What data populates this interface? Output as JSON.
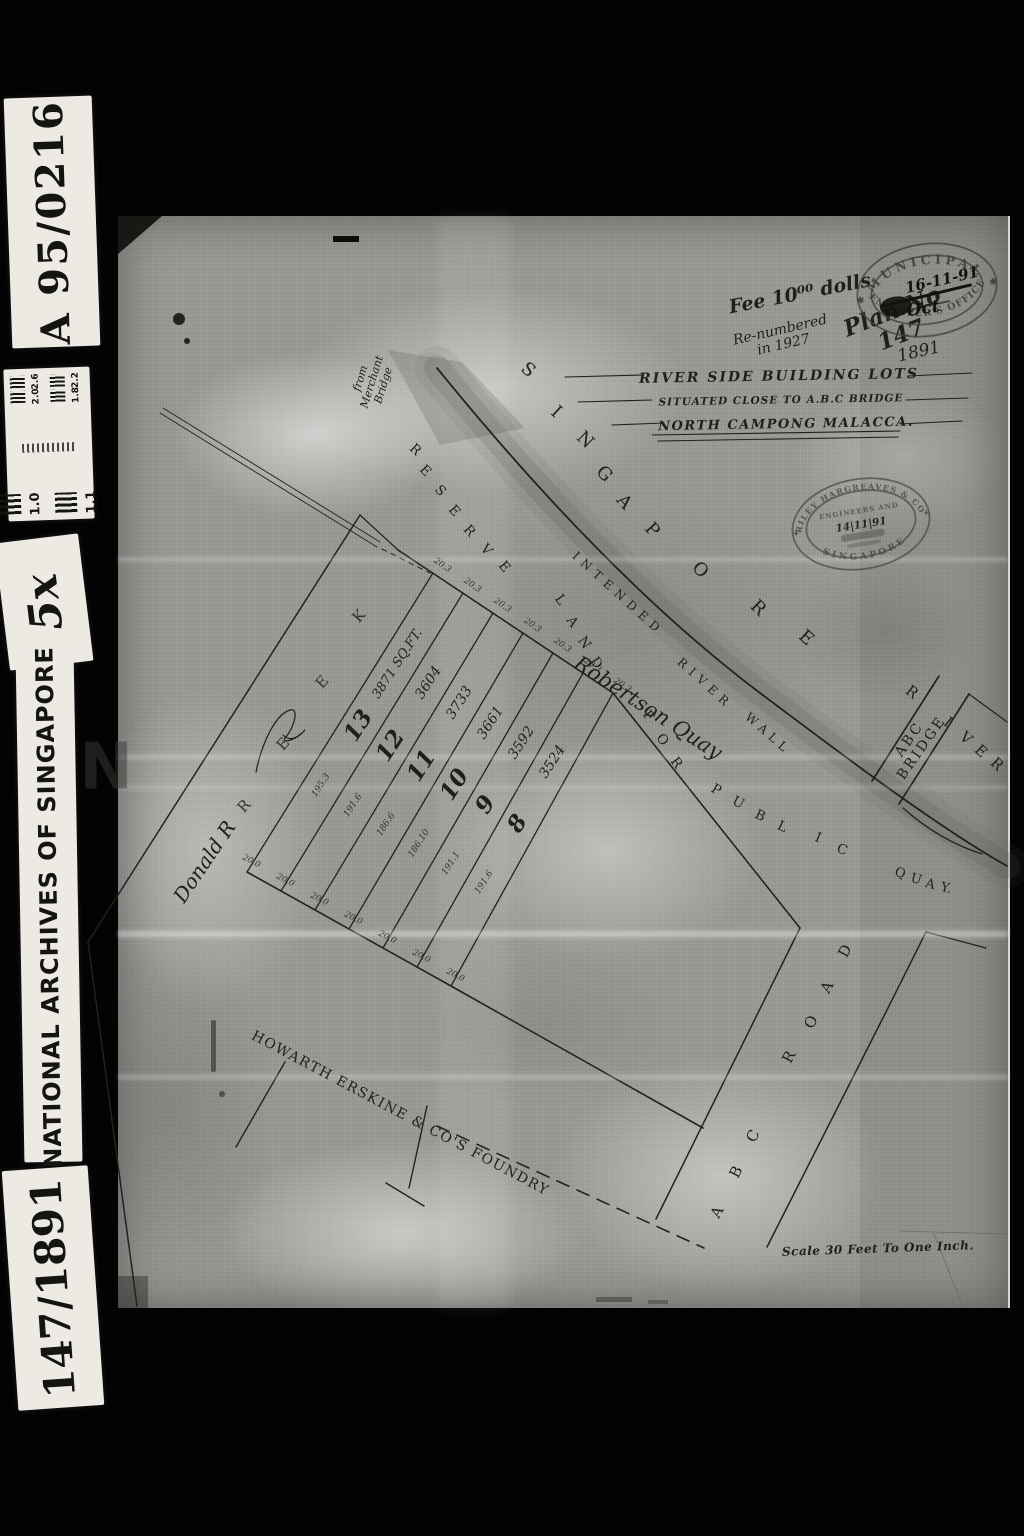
{
  "frame": {
    "catalog_ref": "A 95/0216",
    "magnification": "5x",
    "institution": "NATIONAL ARCHIVES OF SINGAPORE",
    "item_ref": "147/1891",
    "calibration": {
      "left": [
        "1.0",
        "1.1"
      ],
      "right": [
        "2.6",
        "2.2",
        "2.0",
        "1.8"
      ]
    }
  },
  "title_block": {
    "line1": "RIVER SIDE BUILDING LOTS",
    "line2": "SITUATED CLOSE TO A.B.C BRIDGE",
    "line3": "NORTH CAMPONG MALACCA."
  },
  "plan": {
    "lots": [
      {
        "number": "13",
        "area": "3871 SQ.FT.",
        "side": "195.3"
      },
      {
        "number": "12",
        "area": "3604",
        "side": "191.6"
      },
      {
        "number": "11",
        "area": "3733",
        "side": "186.6"
      },
      {
        "number": "10",
        "area": "3661",
        "side": "186.10"
      },
      {
        "number": "9",
        "area": "3592",
        "side": "191.1"
      },
      {
        "number": "8",
        "area": "3524",
        "side": "191.6"
      }
    ],
    "top_dimension": "20.3",
    "bottom_dimension": "20.0",
    "labels": {
      "river_upper": "SINGAPORE",
      "river_lower": "RIVER",
      "reserve_strip": "RESERVE LAND FOR PUBLIC QUAY",
      "wall": "INTENDED RIVER WALL",
      "bridge": "ABC BRIDGE",
      "road": "ABC ROAD",
      "foundry": "HOWARTH ERSKINE & CO'S FOUNDRY",
      "scale": "Scale 30 Feet To One Inch."
    }
  },
  "annotations": {
    "fee": "Fee 10⁰⁰ dolls",
    "renumbered": "Re-numbered\nin 1927",
    "plan_no": "Plan No 147",
    "year": "1891",
    "merchant_bridge": "from\nMerchant\nBridge",
    "robertson": "Robertson Quay",
    "owner_sig": "Donald R",
    "watermark": "N"
  },
  "stamps": {
    "municipal": {
      "ring_top": "MUNICIPAL",
      "ring_bottom": "ENGINEER'S OFFICE",
      "date": "16-11-91",
      "month": "Oct",
      "star": "✱"
    },
    "hargreaves": {
      "ring_top": "RILEY HARGREAVES & CO",
      "ring_bottom": "SINGAPORE",
      "inner": "ENGINEERS AND",
      "date": "14|11|91",
      "star": "✦"
    }
  },
  "scatter": [
    {
      "b": "title_block.line1",
      "x": 779,
      "y": 377,
      "r": -1,
      "s": 14,
      "ls": 2,
      "c": "ttl",
      "n": "title-line-1"
    },
    {
      "b": "title_block.line2",
      "x": 781,
      "y": 401,
      "r": -1,
      "s": 10.5,
      "ls": 1,
      "c": "ttl",
      "n": "title-line-2"
    },
    {
      "b": "title_block.line3",
      "x": 786,
      "y": 425,
      "r": -1,
      "s": 13,
      "ls": 1.5,
      "c": "ttl",
      "n": "title-line-3"
    },
    {
      "t": "S",
      "x": 528,
      "y": 370,
      "r": 40,
      "s": 18,
      "c": "ltr",
      "n": "singapore-letter"
    },
    {
      "t": "I",
      "x": 556,
      "y": 412,
      "r": 42,
      "s": 18,
      "c": "ltr",
      "n": "singapore-letter"
    },
    {
      "t": "N",
      "x": 585,
      "y": 440,
      "r": 44,
      "s": 18,
      "c": "ltr",
      "n": "singapore-letter"
    },
    {
      "t": "G",
      "x": 604,
      "y": 474,
      "r": 46,
      "s": 18,
      "c": "ltr",
      "n": "singapore-letter"
    },
    {
      "t": "A",
      "x": 624,
      "y": 502,
      "r": 48,
      "s": 18,
      "c": "ltr",
      "n": "singapore-letter"
    },
    {
      "t": "P",
      "x": 652,
      "y": 530,
      "r": 48,
      "s": 18,
      "c": "ltr",
      "n": "singapore-letter"
    },
    {
      "t": "O",
      "x": 700,
      "y": 570,
      "r": 46,
      "s": 18,
      "c": "ltr",
      "n": "singapore-letter"
    },
    {
      "t": "R",
      "x": 758,
      "y": 608,
      "r": 44,
      "s": 18,
      "c": "ltr",
      "n": "singapore-letter"
    },
    {
      "t": "E",
      "x": 806,
      "y": 638,
      "r": 42,
      "s": 18,
      "c": "ltr",
      "n": "singapore-letter"
    },
    {
      "t": "R",
      "x": 912,
      "y": 692,
      "r": 38,
      "s": 15,
      "c": "ltr",
      "n": "river-letter"
    },
    {
      "t": "I",
      "x": 948,
      "y": 722,
      "r": 40,
      "s": 15,
      "c": "ltr",
      "n": "river-letter"
    },
    {
      "t": "V",
      "x": 966,
      "y": 738,
      "r": 42,
      "s": 15,
      "c": "ltr",
      "n": "river-letter"
    },
    {
      "t": "E",
      "x": 981,
      "y": 751,
      "r": 43,
      "s": 15,
      "c": "ltr",
      "n": "river-letter"
    },
    {
      "t": "R",
      "x": 997,
      "y": 764,
      "r": 44,
      "s": 15,
      "c": "ltr",
      "n": "river-letter"
    },
    {
      "t": "R",
      "x": 415,
      "y": 450,
      "r": 44,
      "s": 13.5,
      "c": "ltr",
      "n": "reserve-letter"
    },
    {
      "t": "E",
      "x": 425,
      "y": 471,
      "r": 46,
      "s": 13.5,
      "c": "ltr",
      "n": "reserve-letter"
    },
    {
      "t": "S",
      "x": 440,
      "y": 491,
      "r": 47,
      "s": 13.5,
      "c": "ltr",
      "n": "reserve-letter"
    },
    {
      "t": "E",
      "x": 454,
      "y": 511,
      "r": 48,
      "s": 13.5,
      "c": "ltr",
      "n": "reserve-letter"
    },
    {
      "t": "R",
      "x": 469,
      "y": 531,
      "r": 49,
      "s": 13.5,
      "c": "ltr",
      "n": "reserve-letter"
    },
    {
      "t": "V",
      "x": 486,
      "y": 550,
      "r": 50,
      "s": 13.5,
      "c": "ltr",
      "n": "reserve-letter"
    },
    {
      "t": "E",
      "x": 504,
      "y": 567,
      "r": 51,
      "s": 13.5,
      "c": "ltr",
      "n": "reserve-letter"
    },
    {
      "t": "L",
      "x": 560,
      "y": 600,
      "r": 54,
      "s": 13.5,
      "c": "ltr",
      "n": "land-letter"
    },
    {
      "t": "A",
      "x": 572,
      "y": 622,
      "r": 55,
      "s": 13.5,
      "c": "ltr",
      "n": "land-letter"
    },
    {
      "t": "N",
      "x": 584,
      "y": 643,
      "r": 56,
      "s": 13.5,
      "c": "ltr",
      "n": "land-letter"
    },
    {
      "t": "D",
      "x": 596,
      "y": 663,
      "r": 56,
      "s": 13.5,
      "c": "ltr",
      "n": "land-letter"
    },
    {
      "t": "F",
      "x": 648,
      "y": 716,
      "r": 52,
      "s": 13.5,
      "c": "ltr",
      "n": "for-letter"
    },
    {
      "t": "O",
      "x": 662,
      "y": 740,
      "r": 53,
      "s": 13.5,
      "c": "ltr",
      "n": "for-letter"
    },
    {
      "t": "R",
      "x": 676,
      "y": 763,
      "r": 54,
      "s": 13.5,
      "c": "ltr",
      "n": "for-letter"
    },
    {
      "t": "P",
      "x": 716,
      "y": 790,
      "r": 30,
      "s": 13.5,
      "c": "ltr",
      "n": "public-letter"
    },
    {
      "t": "U",
      "x": 738,
      "y": 803,
      "r": 28,
      "s": 13.5,
      "c": "ltr",
      "n": "public-letter"
    },
    {
      "t": "B",
      "x": 760,
      "y": 816,
      "r": 26,
      "s": 13.5,
      "c": "ltr",
      "n": "public-letter"
    },
    {
      "t": "L",
      "x": 782,
      "y": 827,
      "r": 24,
      "s": 13.5,
      "c": "ltr",
      "n": "public-letter"
    },
    {
      "t": "I",
      "x": 818,
      "y": 838,
      "r": 22,
      "s": 13.5,
      "c": "ltr",
      "n": "public-letter"
    },
    {
      "t": "C",
      "x": 842,
      "y": 850,
      "r": 20,
      "s": 13.5,
      "c": "ltr",
      "n": "public-letter"
    },
    {
      "t": "Q",
      "x": 900,
      "y": 874,
      "r": 16,
      "s": 13,
      "c": "ltr",
      "n": "quay-letter"
    },
    {
      "t": "U",
      "x": 916,
      "y": 880,
      "r": 15,
      "s": 13,
      "c": "ltr",
      "n": "quay-letter"
    },
    {
      "t": "A",
      "x": 930,
      "y": 885,
      "r": 14,
      "s": 13,
      "c": "ltr",
      "n": "quay-letter"
    },
    {
      "t": "Y.",
      "x": 946,
      "y": 889,
      "r": 13,
      "s": 13,
      "c": "ltr",
      "n": "quay-letter"
    },
    {
      "t": "INTENDED",
      "x": 618,
      "y": 594,
      "r": 42,
      "s": 12,
      "ls": 6,
      "c": "wrd",
      "n": "river-wall-label"
    },
    {
      "t": "RIVER",
      "x": 705,
      "y": 684,
      "r": 42,
      "s": 12,
      "ls": 6,
      "c": "wrd",
      "n": "river-wall-label"
    },
    {
      "t": "WALL",
      "x": 768,
      "y": 734,
      "r": 41,
      "s": 12,
      "ls": 5,
      "c": "wrd",
      "n": "river-wall-label"
    },
    {
      "b": "plan.labels.bridge",
      "x": 916,
      "y": 744,
      "r": -55,
      "s": 14,
      "ls": 2.5,
      "c": "wrd",
      "n": "bridge-label"
    },
    {
      "t": "A",
      "x": 717,
      "y": 1212,
      "r": -62,
      "s": 15,
      "c": "ltr",
      "n": "road-letter"
    },
    {
      "t": "B",
      "x": 736,
      "y": 1172,
      "r": -62,
      "s": 15,
      "c": "ltr",
      "n": "road-letter"
    },
    {
      "t": "C",
      "x": 753,
      "y": 1136,
      "r": -62,
      "s": 15,
      "c": "ltr",
      "n": "road-letter"
    },
    {
      "t": "R",
      "x": 789,
      "y": 1057,
      "r": -62,
      "s": 15,
      "c": "ltr",
      "n": "road-letter"
    },
    {
      "t": "O",
      "x": 811,
      "y": 1022,
      "r": -62,
      "s": 15,
      "c": "ltr",
      "n": "road-letter"
    },
    {
      "t": "A",
      "x": 827,
      "y": 987,
      "r": -62,
      "s": 15,
      "c": "ltr",
      "n": "road-letter"
    },
    {
      "t": "D",
      "x": 845,
      "y": 951,
      "r": -62,
      "s": 15,
      "c": "ltr",
      "n": "road-letter"
    },
    {
      "t": "R",
      "x": 244,
      "y": 806,
      "r": -48,
      "s": 15,
      "o": 0.85,
      "c": "ltr",
      "n": "creek-letter"
    },
    {
      "t": "E",
      "x": 283,
      "y": 744,
      "r": -48,
      "s": 15,
      "o": 0.85,
      "c": "ltr",
      "n": "creek-letter"
    },
    {
      "t": "E",
      "x": 322,
      "y": 682,
      "r": -48,
      "s": 15,
      "o": 0.85,
      "c": "ltr",
      "n": "creek-letter"
    },
    {
      "t": "K",
      "x": 359,
      "y": 616,
      "r": -48,
      "s": 15,
      "o": 0.85,
      "c": "ltr",
      "n": "creek-letter"
    },
    {
      "b": "plan.labels.foundry",
      "x": 400,
      "y": 1114,
      "r": 28,
      "s": 14,
      "ls": 1.5,
      "c": "wrd",
      "n": "foundry-label"
    },
    {
      "b": "plan.lots.0.area",
      "x": 398,
      "y": 664,
      "r": -57,
      "s": 13,
      "c": "hw",
      "n": "lot-area"
    },
    {
      "b": "plan.lots.1.area",
      "x": 429,
      "y": 683,
      "r": -57,
      "s": 14,
      "c": "hw",
      "n": "lot-area"
    },
    {
      "b": "plan.lots.2.area",
      "x": 460,
      "y": 703,
      "r": -57,
      "s": 14,
      "c": "hw",
      "n": "lot-area"
    },
    {
      "b": "plan.lots.3.area",
      "x": 491,
      "y": 723,
      "r": -57,
      "s": 14,
      "c": "hw",
      "n": "lot-area"
    },
    {
      "b": "plan.lots.4.area",
      "x": 522,
      "y": 743,
      "r": -57,
      "s": 14,
      "c": "hw",
      "n": "lot-area"
    },
    {
      "b": "plan.lots.5.area",
      "x": 553,
      "y": 762,
      "r": -57,
      "s": 14,
      "c": "hw",
      "n": "lot-area"
    },
    {
      "b": "plan.lots.0.number",
      "x": 359,
      "y": 726,
      "r": -57,
      "s": 23,
      "c": "num",
      "n": "lot-number"
    },
    {
      "b": "plan.lots.1.number",
      "x": 391,
      "y": 746,
      "r": -57,
      "s": 23,
      "c": "num",
      "n": "lot-number"
    },
    {
      "b": "plan.lots.2.number",
      "x": 422,
      "y": 766,
      "r": -57,
      "s": 23,
      "c": "num",
      "n": "lot-number"
    },
    {
      "b": "plan.lots.3.number",
      "x": 455,
      "y": 785,
      "r": -57,
      "s": 23,
      "c": "num",
      "n": "lot-number"
    },
    {
      "b": "plan.lots.4.number",
      "x": 486,
      "y": 805,
      "r": -57,
      "s": 23,
      "c": "num",
      "n": "lot-number"
    },
    {
      "b": "plan.lots.5.number",
      "x": 518,
      "y": 824,
      "r": -57,
      "s": 23,
      "c": "num",
      "n": "lot-number"
    },
    {
      "b": "plan.lots.0.side",
      "x": 322,
      "y": 786,
      "r": -57,
      "s": 9,
      "c": "dim",
      "n": "lot-side-dimension"
    },
    {
      "b": "plan.lots.1.side",
      "x": 354,
      "y": 806,
      "r": -57,
      "s": 9,
      "c": "dim",
      "n": "lot-side-dimension"
    },
    {
      "b": "plan.lots.2.side",
      "x": 387,
      "y": 825,
      "r": -57,
      "s": 9,
      "c": "dim",
      "n": "lot-side-dimension"
    },
    {
      "b": "plan.lots.3.side",
      "x": 420,
      "y": 844,
      "r": -57,
      "s": 9,
      "c": "dim",
      "n": "lot-side-dimension"
    },
    {
      "b": "plan.lots.4.side",
      "x": 452,
      "y": 864,
      "r": -57,
      "s": 9,
      "c": "dim",
      "n": "lot-side-dimension"
    },
    {
      "b": "plan.lots.5.side",
      "x": 485,
      "y": 883,
      "r": -57,
      "s": 9,
      "c": "dim",
      "n": "lot-side-dimension"
    },
    {
      "b": "plan.top_dimension",
      "x": 442,
      "y": 566,
      "r": 35,
      "s": 8.5,
      "c": "dim",
      "n": "frontage-dimension"
    },
    {
      "b": "plan.top_dimension",
      "x": 472,
      "y": 586,
      "r": 35,
      "s": 8.5,
      "c": "dim",
      "n": "frontage-dimension"
    },
    {
      "b": "plan.top_dimension",
      "x": 502,
      "y": 606,
      "r": 35,
      "s": 8.5,
      "c": "dim",
      "n": "frontage-dimension"
    },
    {
      "b": "plan.top_dimension",
      "x": 532,
      "y": 626,
      "r": 35,
      "s": 8.5,
      "c": "dim",
      "n": "frontage-dimension"
    },
    {
      "b": "plan.top_dimension",
      "x": 562,
      "y": 646,
      "r": 35,
      "s": 8.5,
      "c": "dim",
      "n": "frontage-dimension"
    },
    {
      "b": "plan.top_dimension",
      "x": 592,
      "y": 666,
      "r": 35,
      "s": 8.5,
      "c": "dim",
      "n": "frontage-dimension"
    },
    {
      "b": "plan.top_dimension",
      "x": 622,
      "y": 686,
      "r": 35,
      "s": 8.5,
      "c": "dim",
      "n": "frontage-dimension"
    },
    {
      "b": "plan.bottom_dimension",
      "x": 251,
      "y": 862,
      "r": 27,
      "s": 8.5,
      "c": "dim",
      "n": "rear-dimension"
    },
    {
      "b": "plan.bottom_dimension",
      "x": 285,
      "y": 881,
      "r": 27,
      "s": 8.5,
      "c": "dim",
      "n": "rear-dimension"
    },
    {
      "b": "plan.bottom_dimension",
      "x": 319,
      "y": 900,
      "r": 27,
      "s": 8.5,
      "c": "dim",
      "n": "rear-dimension"
    },
    {
      "b": "plan.bottom_dimension",
      "x": 353,
      "y": 919,
      "r": 27,
      "s": 8.5,
      "c": "dim",
      "n": "rear-dimension"
    },
    {
      "b": "plan.bottom_dimension",
      "x": 387,
      "y": 938,
      "r": 27,
      "s": 8.5,
      "c": "dim",
      "n": "rear-dimension"
    },
    {
      "b": "plan.bottom_dimension",
      "x": 421,
      "y": 957,
      "r": 27,
      "s": 8.5,
      "c": "dim",
      "n": "rear-dimension"
    },
    {
      "b": "plan.bottom_dimension",
      "x": 455,
      "y": 976,
      "r": 27,
      "s": 8.5,
      "c": "dim",
      "n": "rear-dimension"
    },
    {
      "b": "annotations.fee",
      "x": 800,
      "y": 294,
      "r": -11,
      "s": 19,
      "c": "hwb",
      "n": "fee-note"
    },
    {
      "b": "annotations.renumbered",
      "x": 782,
      "y": 338,
      "r": -13,
      "s": 14,
      "c": "hw",
      "n": "renumbered-note"
    },
    {
      "b": "annotations.plan_no",
      "x": 897,
      "y": 324,
      "r": -21,
      "s": 23,
      "c": "hwb",
      "n": "plan-number-note"
    },
    {
      "b": "annotations.year",
      "x": 919,
      "y": 352,
      "r": -13,
      "s": 17,
      "c": "hw",
      "n": "plan-year-note"
    },
    {
      "b": "annotations.merchant_bridge",
      "x": 372,
      "y": 382,
      "r": -73,
      "s": 11,
      "c": "hw",
      "n": "merchant-bridge-note"
    },
    {
      "b": "annotations.robertson",
      "x": 648,
      "y": 708,
      "r": 33,
      "s": 21,
      "c": "hw",
      "n": "robertson-quay-note"
    },
    {
      "b": "annotations.owner_sig",
      "x": 205,
      "y": 862,
      "r": -56,
      "s": 20,
      "c": "hw",
      "n": "owner-signature"
    },
    {
      "b": "plan.labels.scale",
      "x": 878,
      "y": 1249,
      "r": -2,
      "s": 12,
      "ls": 0.5,
      "c": "scl",
      "n": "scale-label"
    },
    {
      "b": "annotations.watermark",
      "x": 106,
      "y": 768,
      "r": 0,
      "s": 64,
      "o": 0.5,
      "c": "wm",
      "n": "film-watermark"
    }
  ]
}
